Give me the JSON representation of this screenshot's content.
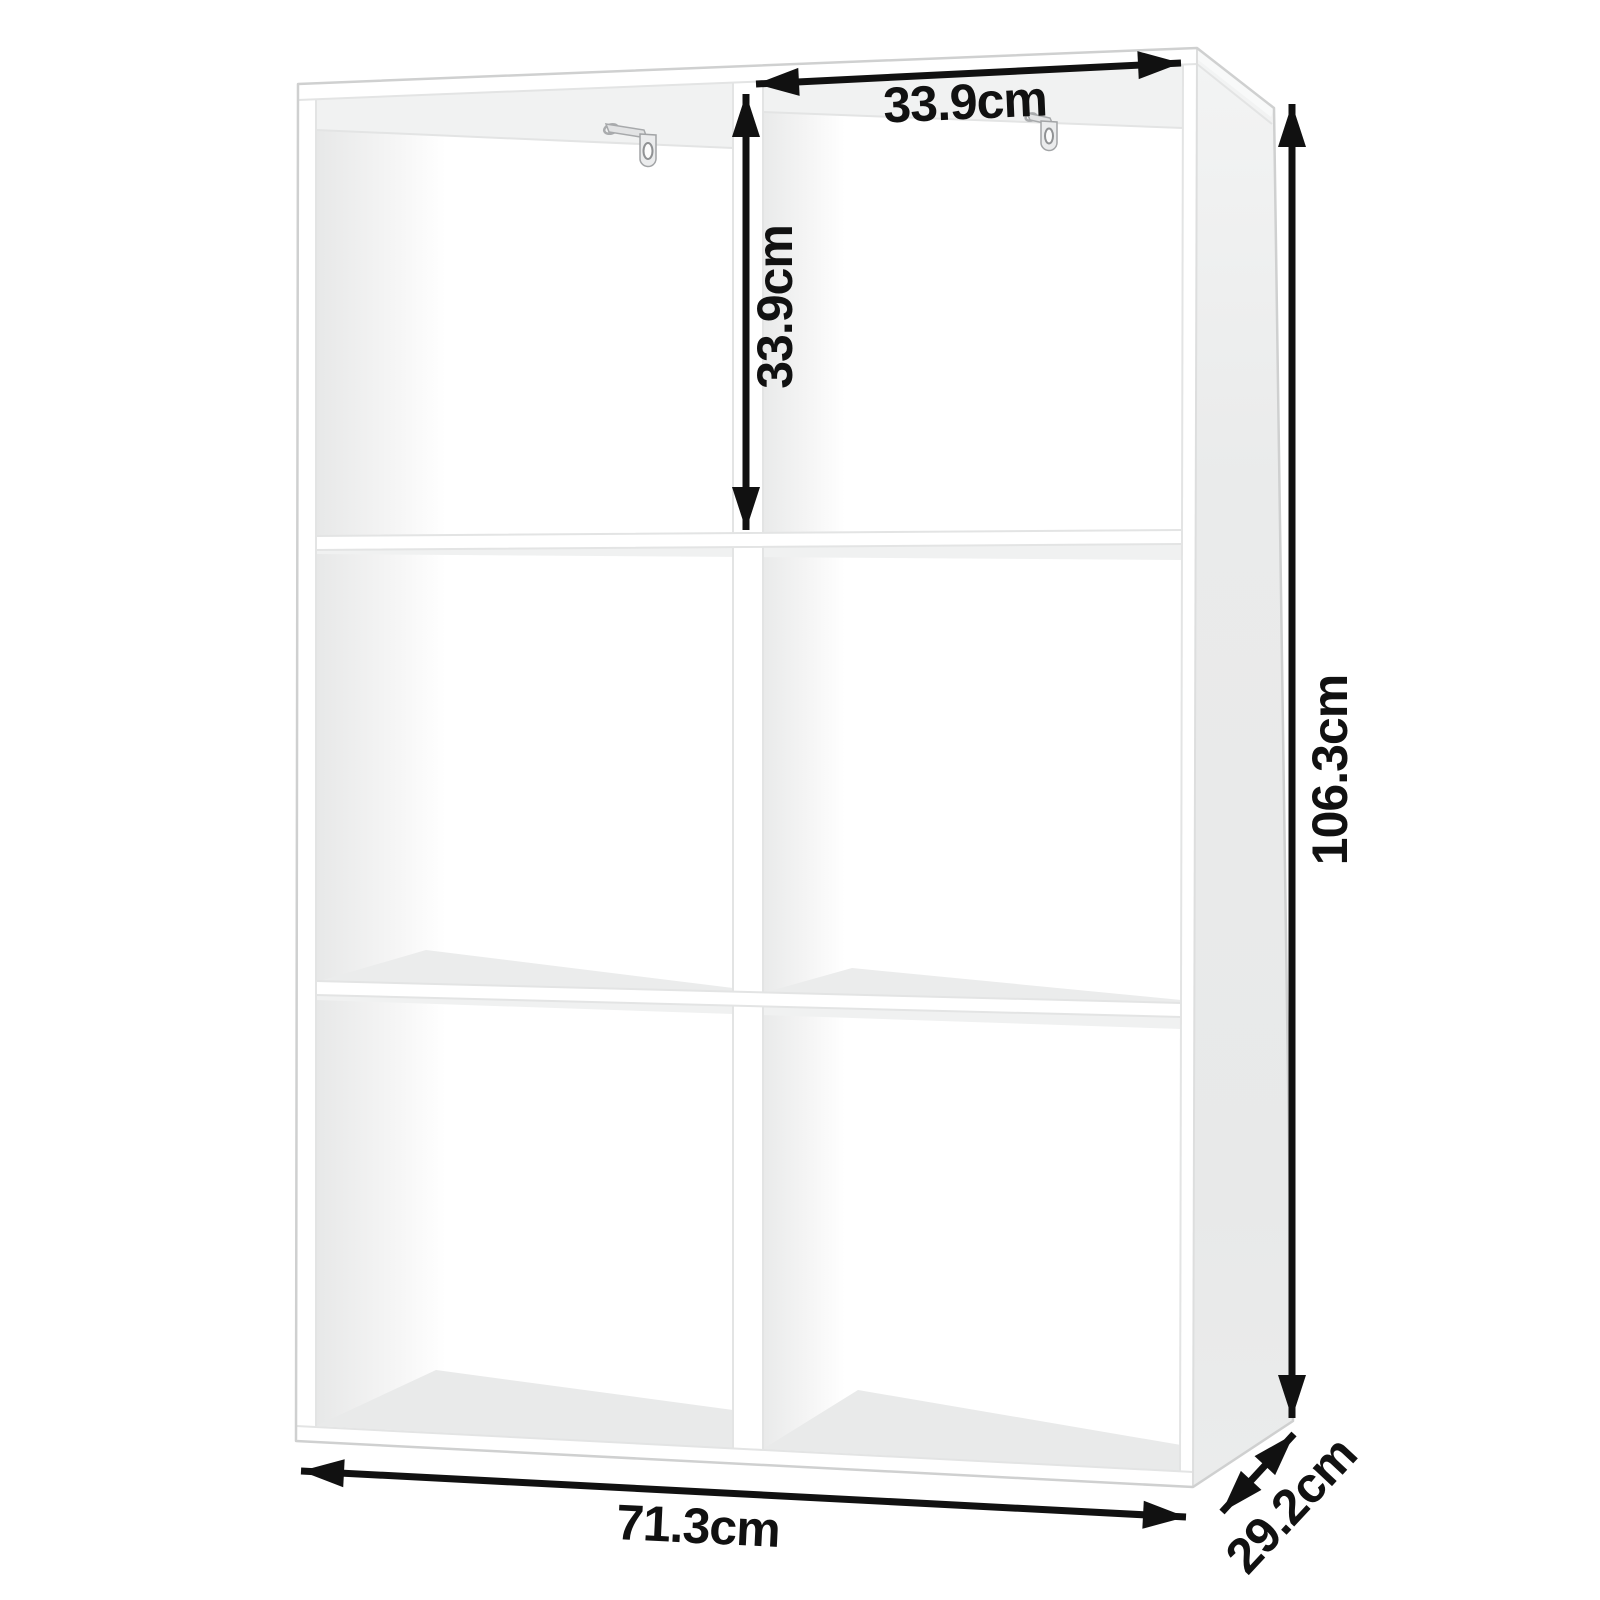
{
  "diagram": {
    "figure": "cube-storage-shelf-dimension-diagram",
    "shelf": {
      "rows": 3,
      "columns": 2,
      "compartments": 6,
      "wall_brackets": 2
    },
    "unit": "cm",
    "labels": {
      "compartment_width": "33.9cm",
      "compartment_height": "33.9cm",
      "total_height": "106.3cm",
      "total_width": "71.3cm",
      "depth": "29.2cm"
    },
    "colors": {
      "background": "#ffffff",
      "furniture": "#ffffff",
      "side_panel_shade": "#eaebeb",
      "interior_shade": "#ededee",
      "edge_line": "#d7d8d8",
      "arrow": "#111111"
    }
  }
}
